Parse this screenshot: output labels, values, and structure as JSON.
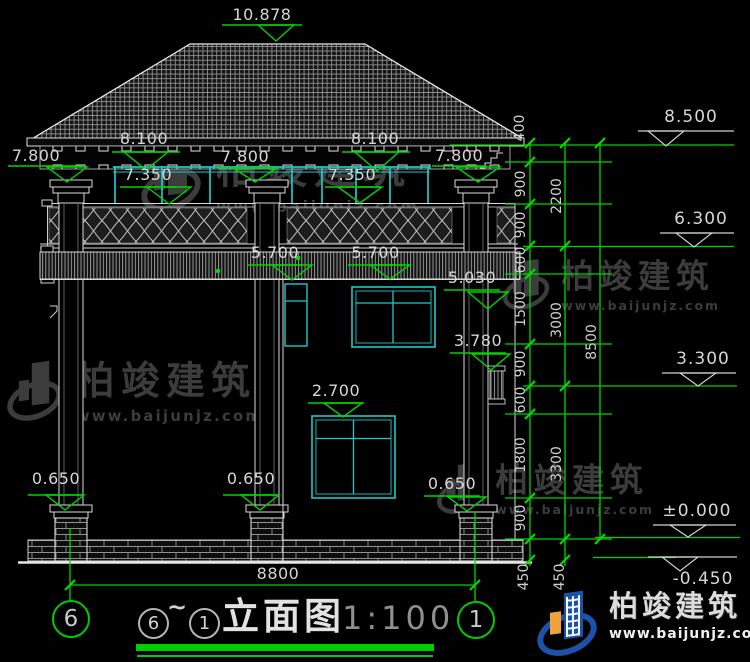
{
  "drawing": {
    "facade_dims": {
      "ridge": "10.878",
      "eave_left": "7.800",
      "eave_mid_left": "8.100",
      "eave_mid": "7.800",
      "eave_mid_right": "8.100",
      "eave_right": "7.800",
      "window_top_left": "7.350",
      "window_top_right": "7.350",
      "balcony_left": "5.700",
      "balcony_right": "5.700",
      "level_5030": "5.030",
      "level_3780": "3.780",
      "level_2700": "2.700",
      "pedestal_left": "0.650",
      "pedestal_mid": "0.650",
      "pedestal_right": "0.650",
      "total_width": "8800"
    },
    "right_levels": {
      "l1": "8.500",
      "l2": "6.300",
      "l3": "3.300",
      "l4": "±0.000",
      "l5": "-0.450"
    },
    "chain1": [
      "400",
      "900",
      "900",
      "600",
      "1500",
      "900",
      "600",
      "1800",
      "900",
      "450"
    ],
    "chain2": [
      "2200",
      "3000",
      "3300",
      "450"
    ],
    "chain3": [
      "8500"
    ],
    "grid_bubbles": {
      "left": "6",
      "right": "1"
    },
    "colors": {
      "dimension_green": "#00d400",
      "window_cyan": "#1fc9c9",
      "title_underline_green": "#00cc00",
      "logo_blue": "#1c53a8",
      "logo_orange": "#f0a23e"
    }
  },
  "titleblock": {
    "from_axis": "6",
    "tilde": "~",
    "to_axis": "1",
    "title": "立面图",
    "scale": "1:100"
  },
  "watermark": {
    "name": "柏竣建筑",
    "url": "www.baijunjz.com"
  },
  "footer_logo": {
    "name": "柏竣建筑",
    "url": "www.baijunjz.com"
  }
}
